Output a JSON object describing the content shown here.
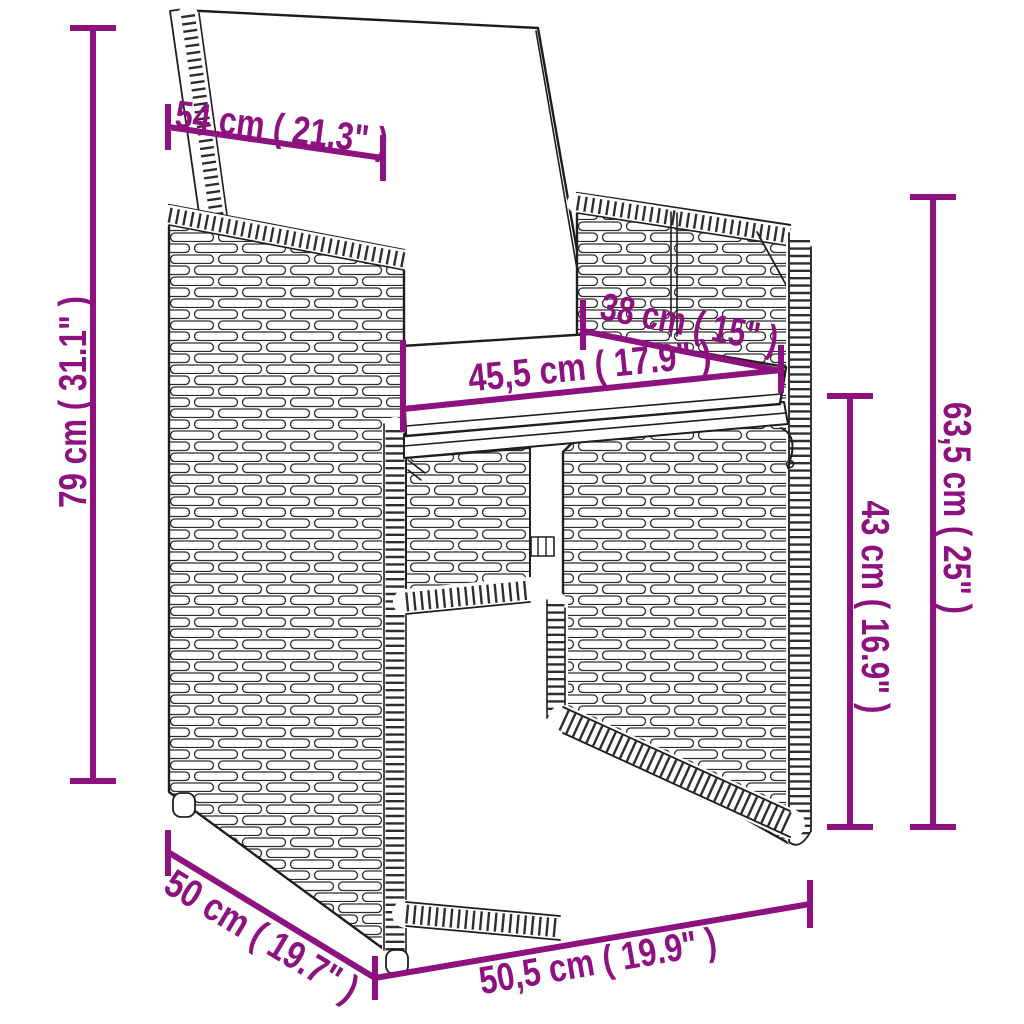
{
  "diagram": {
    "kind": "product-dimension-diagram",
    "subject": "wicker armchair with back and seat cushions",
    "colors": {
      "background": "#ffffff",
      "line_art": "#1e1e1e",
      "dimension_accent": "#8E1180"
    },
    "measurements": {
      "backrest_width": {
        "label": "54 cm ( 21.3\" )",
        "cm": "54",
        "inches": "21.3"
      },
      "total_height": {
        "label": "79 cm ( 31.1\" )",
        "cm": "79",
        "inches": "31.1"
      },
      "seat_depth": {
        "label": "38 cm ( 15\" )",
        "cm": "38",
        "inches": "15"
      },
      "seat_width": {
        "label": "45,5 cm ( 17.9\" )",
        "cm": "45,5",
        "inches": "17.9"
      },
      "armrest_height": {
        "label": "63,5 cm ( 25\" )",
        "cm": "63,5",
        "inches": "25"
      },
      "seat_height": {
        "label": "43 cm ( 16.9\" )",
        "cm": "43",
        "inches": "16.9"
      },
      "base_depth": {
        "label": "50 cm ( 19.7\" )",
        "cm": "50",
        "inches": "19.7"
      },
      "base_width": {
        "label": "50,5 cm ( 19.9\" )",
        "cm": "50,5",
        "inches": "19.9"
      }
    }
  }
}
